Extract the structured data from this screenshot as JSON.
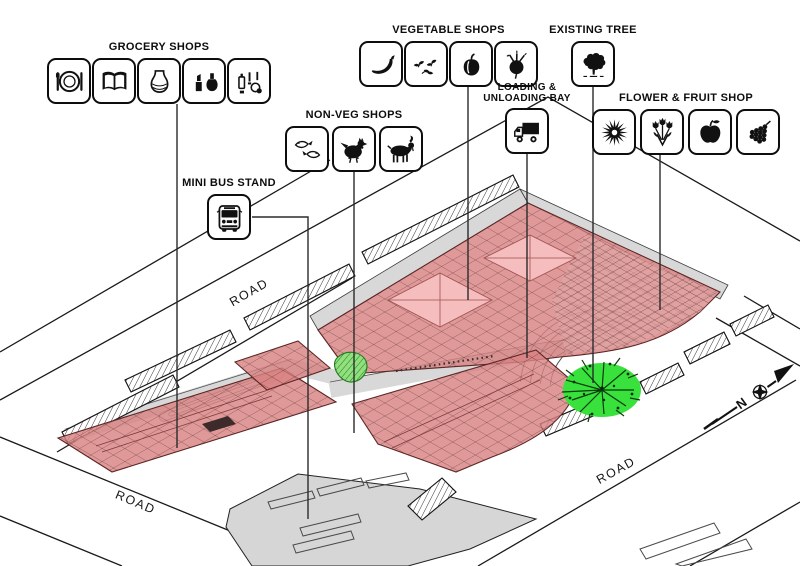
{
  "legend": {
    "grocery": {
      "label": "GROCERY SHOPS",
      "icons": [
        "dining",
        "book",
        "vase",
        "cosmetics",
        "toiletries"
      ]
    },
    "vegetable": {
      "label": "VEGETABLE SHOPS",
      "icons": [
        "chili",
        "leafy-greens",
        "bell-pepper",
        "beetroot"
      ]
    },
    "existing_tree": {
      "label": "EXISTING TREE",
      "icons": [
        "tree"
      ]
    },
    "nonveg": {
      "label": "NON-VEG SHOPS",
      "icons": [
        "fish",
        "chicken",
        "goat"
      ]
    },
    "loading": {
      "label": "LOADING & UNLOADING BAY",
      "icons": [
        "truck"
      ]
    },
    "flower_fruit": {
      "label": "FLOWER & FRUIT SHOP",
      "icons": [
        "sunflower",
        "flower-bouquet",
        "apple",
        "grapes"
      ]
    },
    "minibus": {
      "label": "MINI BUS STAND",
      "icons": [
        "bus"
      ]
    }
  },
  "plan": {
    "road_labels": [
      "ROAD",
      "ROAD",
      "ROAD"
    ],
    "north_label": "N",
    "colors": {
      "roof_red": "#d98282",
      "skylight_pink": "#f5bdbd",
      "tree_green": "#38e13c",
      "lawn_green": "#90e07e",
      "walkway_grey": "#d8d8d8",
      "line_dark": "#1a1a1a"
    }
  }
}
